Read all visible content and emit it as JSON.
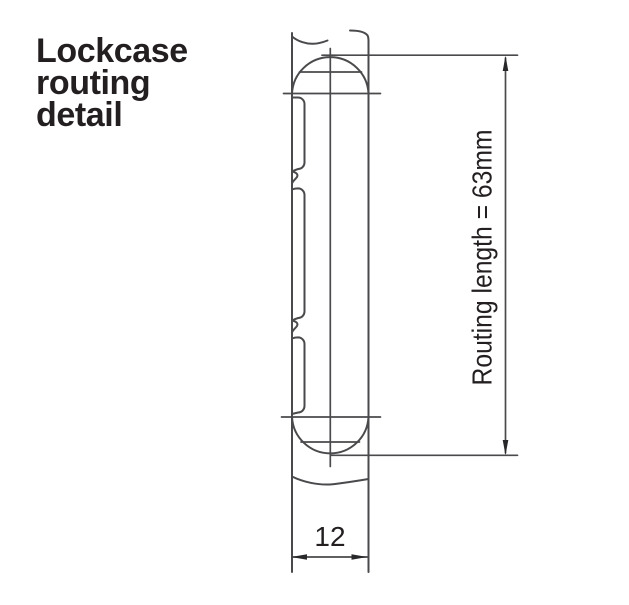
{
  "title": {
    "lines": [
      "Lockcase",
      "routing",
      "detail"
    ]
  },
  "diagram": {
    "routing_length_label": "Routing length = 63mm",
    "routing_length_mm": 63,
    "routing_width_label": "12",
    "routing_width_mm": 12
  },
  "colors": {
    "line": "#4a4a4d",
    "arrow": "#28282a",
    "text": "#231f20",
    "background": "#ffffff"
  }
}
